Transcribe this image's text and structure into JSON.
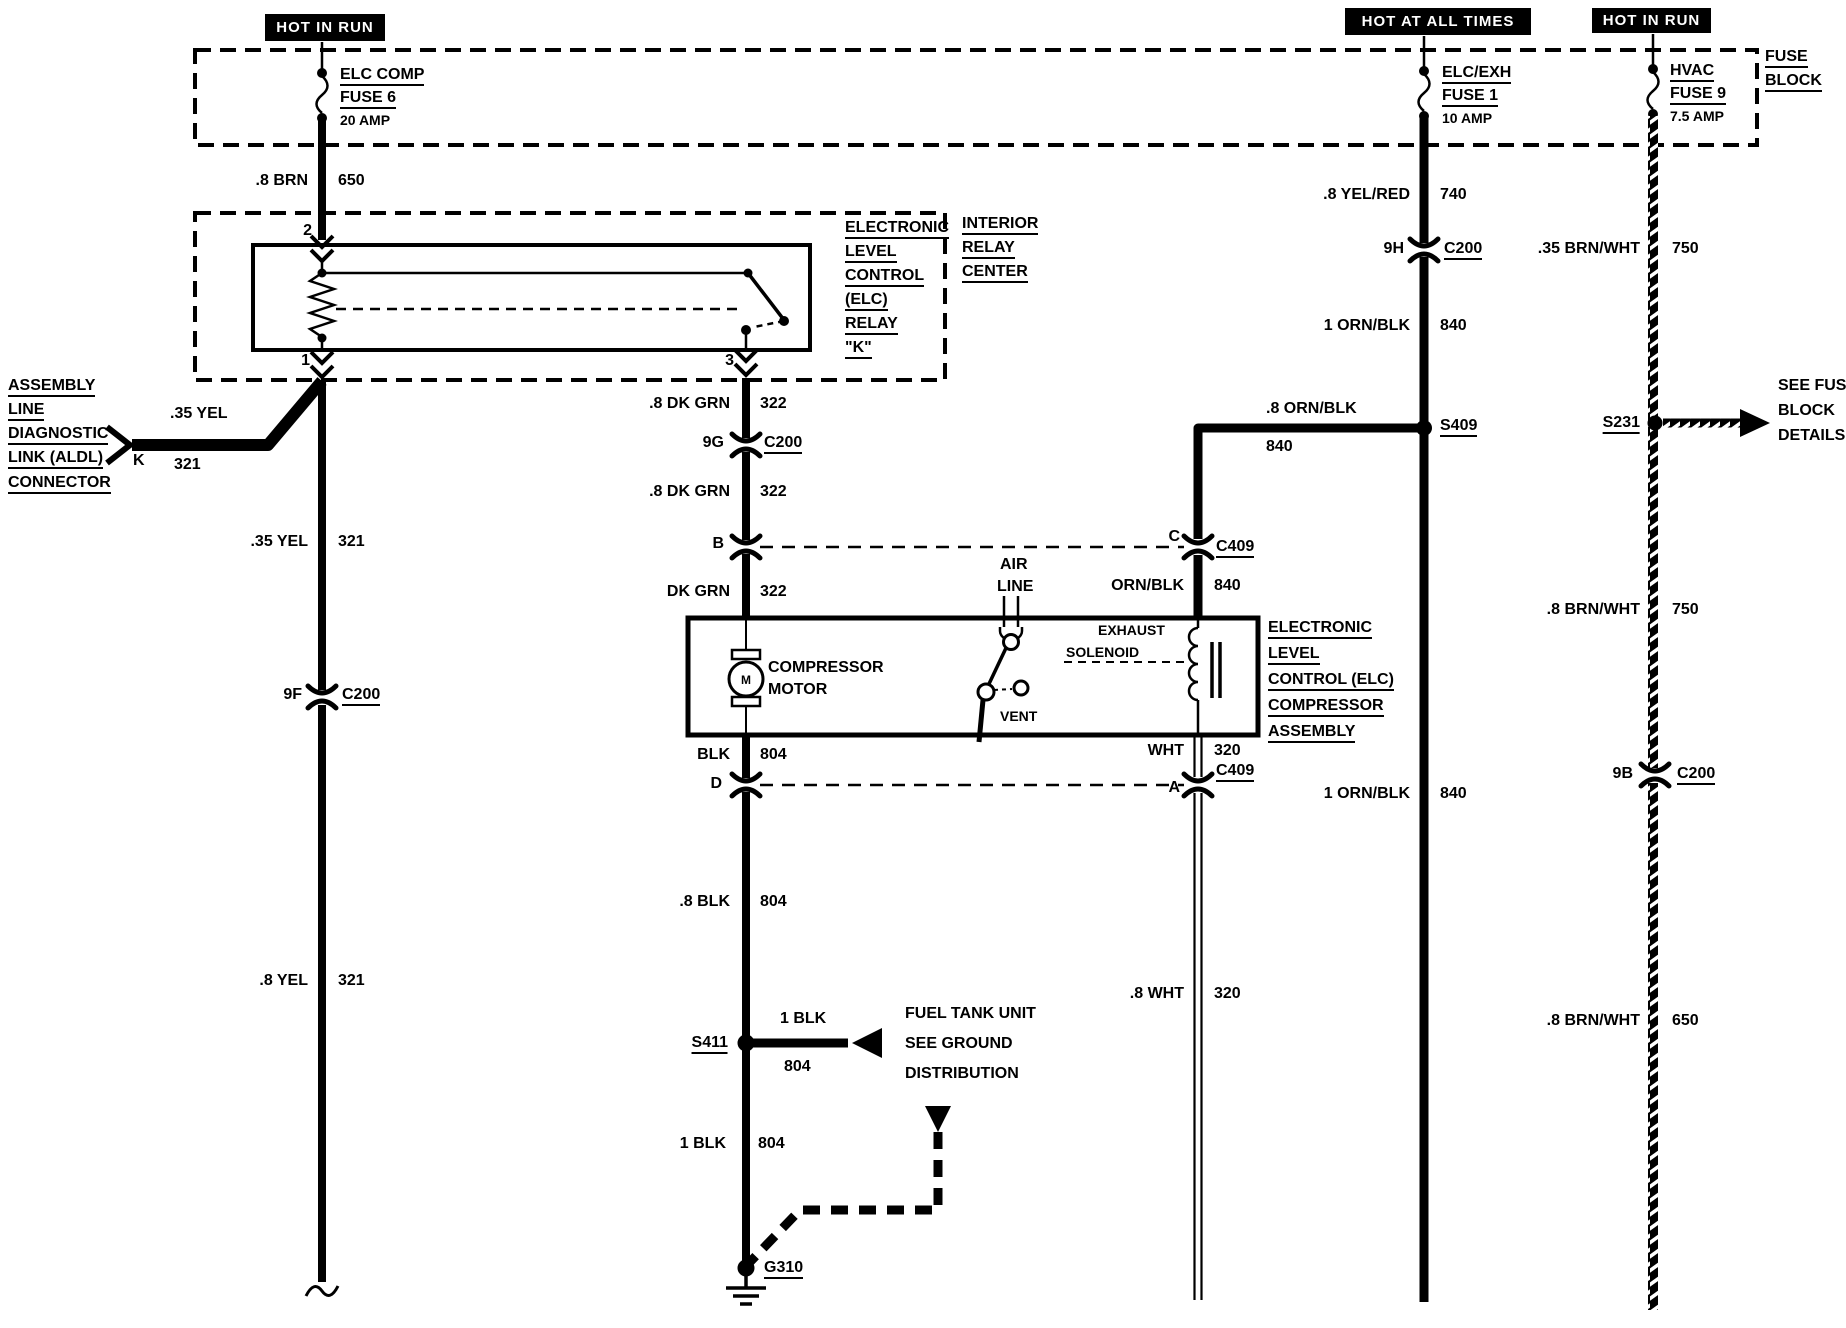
{
  "diagram": {
    "colors": {
      "ink": "#000000",
      "paper": "#ffffff"
    },
    "headers": {
      "hot_in_run_left": "HOT IN RUN",
      "hot_at_all_times": "HOT AT ALL TIMES",
      "hot_in_run_right": "HOT IN RUN"
    },
    "fuse_block": {
      "name": [
        "FUSE",
        "BLOCK"
      ],
      "fuses": [
        {
          "line1": "ELC COMP",
          "line2": "FUSE 6",
          "rating": "20 AMP"
        },
        {
          "line1": "ELC/EXH",
          "line2": "FUSE 1",
          "rating": "10 AMP"
        },
        {
          "line1": "HVAC",
          "line2": "FUSE 9",
          "rating": "7.5 AMP"
        }
      ]
    },
    "interior_relay_center": {
      "name": [
        "INTERIOR",
        "RELAY",
        "CENTER"
      ]
    },
    "elc_relay": {
      "name": [
        "ELECTRONIC",
        "LEVEL",
        "CONTROL",
        "(ELC)",
        "RELAY",
        "\"K\""
      ],
      "terminals": {
        "t1": "1",
        "t2": "2",
        "t3": "3"
      }
    },
    "aldl": {
      "name": [
        "ASSEMBLY",
        "LINE",
        "DIAGNOSTIC",
        "LINK (ALDL)",
        "CONNECTOR"
      ],
      "terminal": "K"
    },
    "compressor_assembly": {
      "name": [
        "ELECTRONIC",
        "LEVEL",
        "CONTROL (ELC)",
        "COMPRESSOR",
        "ASSEMBLY"
      ],
      "motor": [
        "COMPRESSOR",
        "MOTOR"
      ],
      "motor_letter": "M",
      "air_line": [
        "AIR",
        "LINE"
      ],
      "vent": "VENT",
      "exhaust_solenoid": [
        "EXHAUST",
        "SOLENOID"
      ]
    },
    "notes": {
      "fuel_tank": [
        "FUEL TANK UNIT",
        "SEE GROUND",
        "DISTRIBUTION"
      ],
      "fuse_details": [
        "SEE FUSE",
        "BLOCK",
        "DETAILS"
      ]
    },
    "splices": {
      "s409": "S409",
      "s411": "S411",
      "s231": "S231",
      "g310": "G310"
    },
    "connectors": {
      "c200_9f": {
        "pin": "9F",
        "name": "C200"
      },
      "c200_9g": {
        "pin": "9G",
        "name": "C200"
      },
      "c200_9h": {
        "pin": "9H",
        "name": "C200"
      },
      "c200_9b": {
        "pin": "9B",
        "name": "C200"
      },
      "c409_b": {
        "pin": "B"
      },
      "c409_c": {
        "pin": "C",
        "name": "C409"
      },
      "c409_d": {
        "pin": "D"
      },
      "c409_a": {
        "pin": "A",
        "name": "C409"
      }
    },
    "wire_labels": {
      "brn_650": {
        "gauge": ".8 BRN",
        "circuit": "650"
      },
      "yel_321_aldl": {
        "gauge": ".35 YEL",
        "circuit": "321"
      },
      "yel_321_a": {
        "gauge": ".35 YEL",
        "circuit": "321"
      },
      "yel_321_b": {
        "gauge": ".8 YEL",
        "circuit": "321"
      },
      "dkgrn_322_a": {
        "gauge": ".8 DK GRN",
        "circuit": "322"
      },
      "dkgrn_322_b": {
        "gauge": ".8 DK GRN",
        "circuit": "322"
      },
      "dkgrn_322_c": {
        "gauge": "DK GRN",
        "circuit": "322"
      },
      "blk_804_a": {
        "gauge": "BLK",
        "circuit": "804"
      },
      "blk_804_b": {
        "gauge": ".8 BLK",
        "circuit": "804"
      },
      "blk_804_c": {
        "gauge": "1 BLK",
        "circuit": "804"
      },
      "blk_804_d": {
        "gauge": "1 BLK",
        "circuit": "804"
      },
      "ornblk_840_h": {
        "gauge": ".8 ORN/BLK",
        "circuit": "840"
      },
      "ornblk_840_c": {
        "gauge": "ORN/BLK",
        "circuit": "840"
      },
      "wht_320_a": {
        "gauge": "WHT",
        "circuit": "320"
      },
      "wht_320_b": {
        "gauge": ".8 WHT",
        "circuit": "320"
      },
      "yelred_740": {
        "gauge": ".8 YEL/RED",
        "circuit": "740"
      },
      "ornblk_840_a": {
        "gauge": "1 ORN/BLK",
        "circuit": "840"
      },
      "ornblk_840_b": {
        "gauge": "1 ORN/BLK",
        "circuit": "840"
      },
      "brnwht_750_a": {
        "gauge": ".35 BRN/WHT",
        "circuit": "750"
      },
      "brnwht_750_b": {
        "gauge": ".8 BRN/WHT",
        "circuit": "750"
      },
      "brnwht_650": {
        "gauge": ".8 BRN/WHT",
        "circuit": "650"
      }
    }
  }
}
